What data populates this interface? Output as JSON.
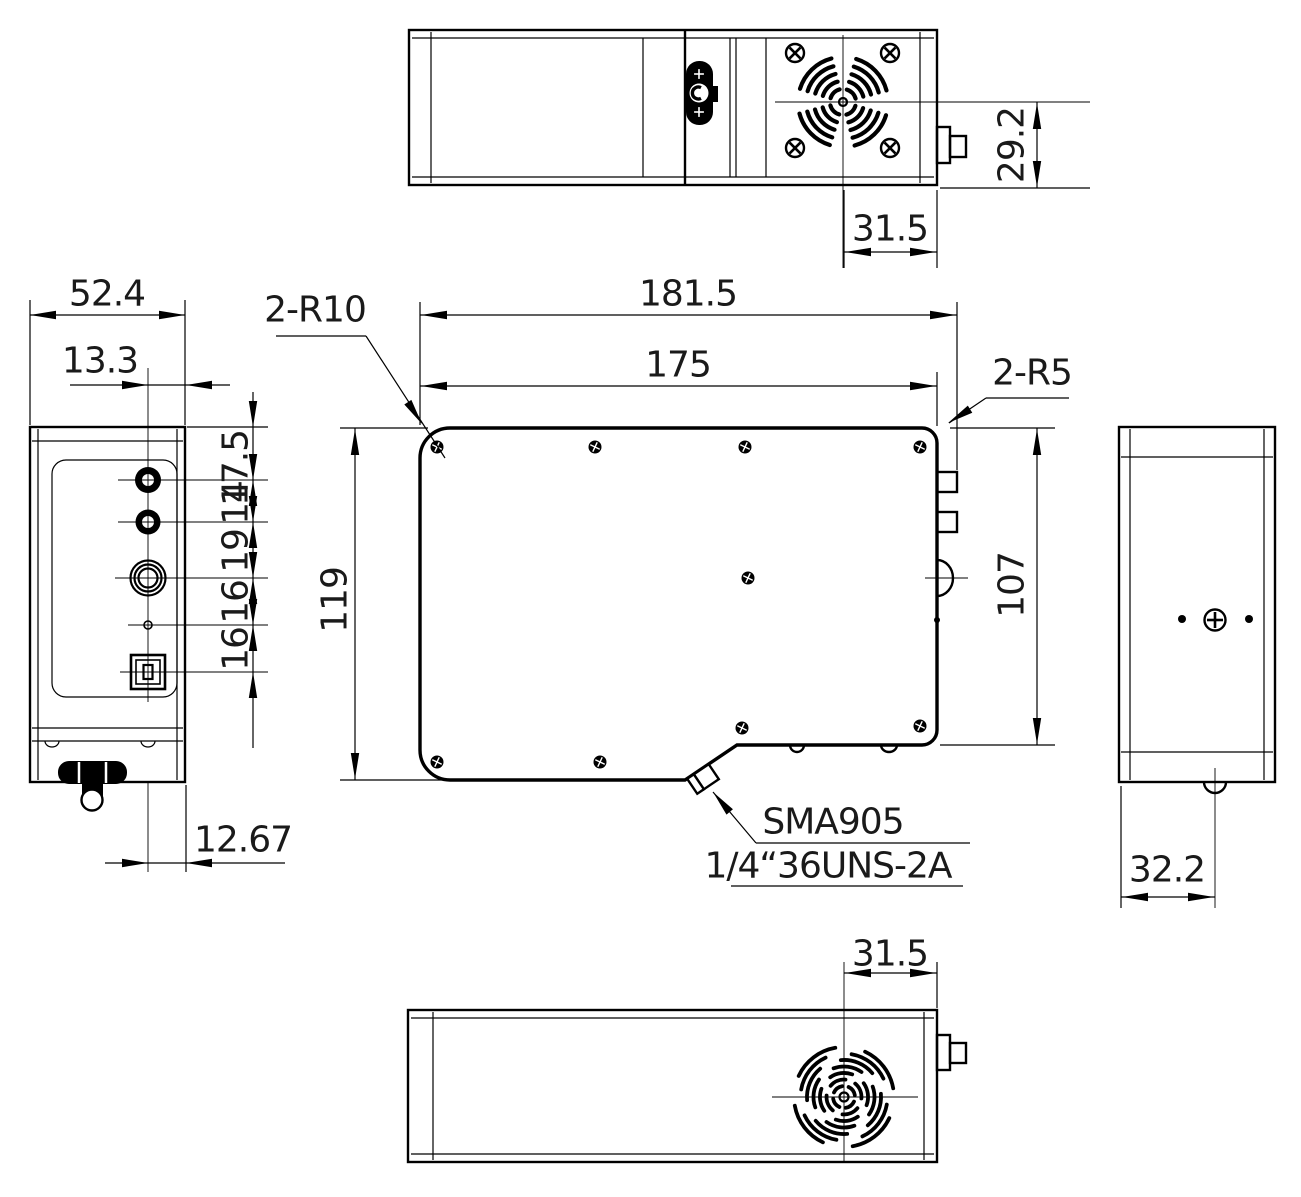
{
  "colors": {
    "line": "#000000",
    "background": "#ffffff",
    "text": "#1a1a1a"
  },
  "views": {
    "top": {
      "dims": {
        "height": "29.2",
        "fan_to_edge": "31.5"
      }
    },
    "left": {
      "dims": {
        "width": "52.4",
        "center_offset": "13.3",
        "bottom_offset": "12.67",
        "stack": [
          "17.5",
          "14",
          "19",
          "16",
          "16"
        ]
      }
    },
    "front": {
      "dims": {
        "overall_width": "181.5",
        "body_width": "175",
        "height": "119",
        "right_height": "107"
      },
      "labels": {
        "corner_r10": "2-R10",
        "corner_r5": "2-R5",
        "connector": "SMA905",
        "thread": "1/4“36UNS-2A"
      }
    },
    "right": {
      "dims": {
        "connector_offset": "32.2"
      }
    },
    "bottom": {
      "dims": {
        "fan_to_edge": "31.5"
      }
    }
  }
}
